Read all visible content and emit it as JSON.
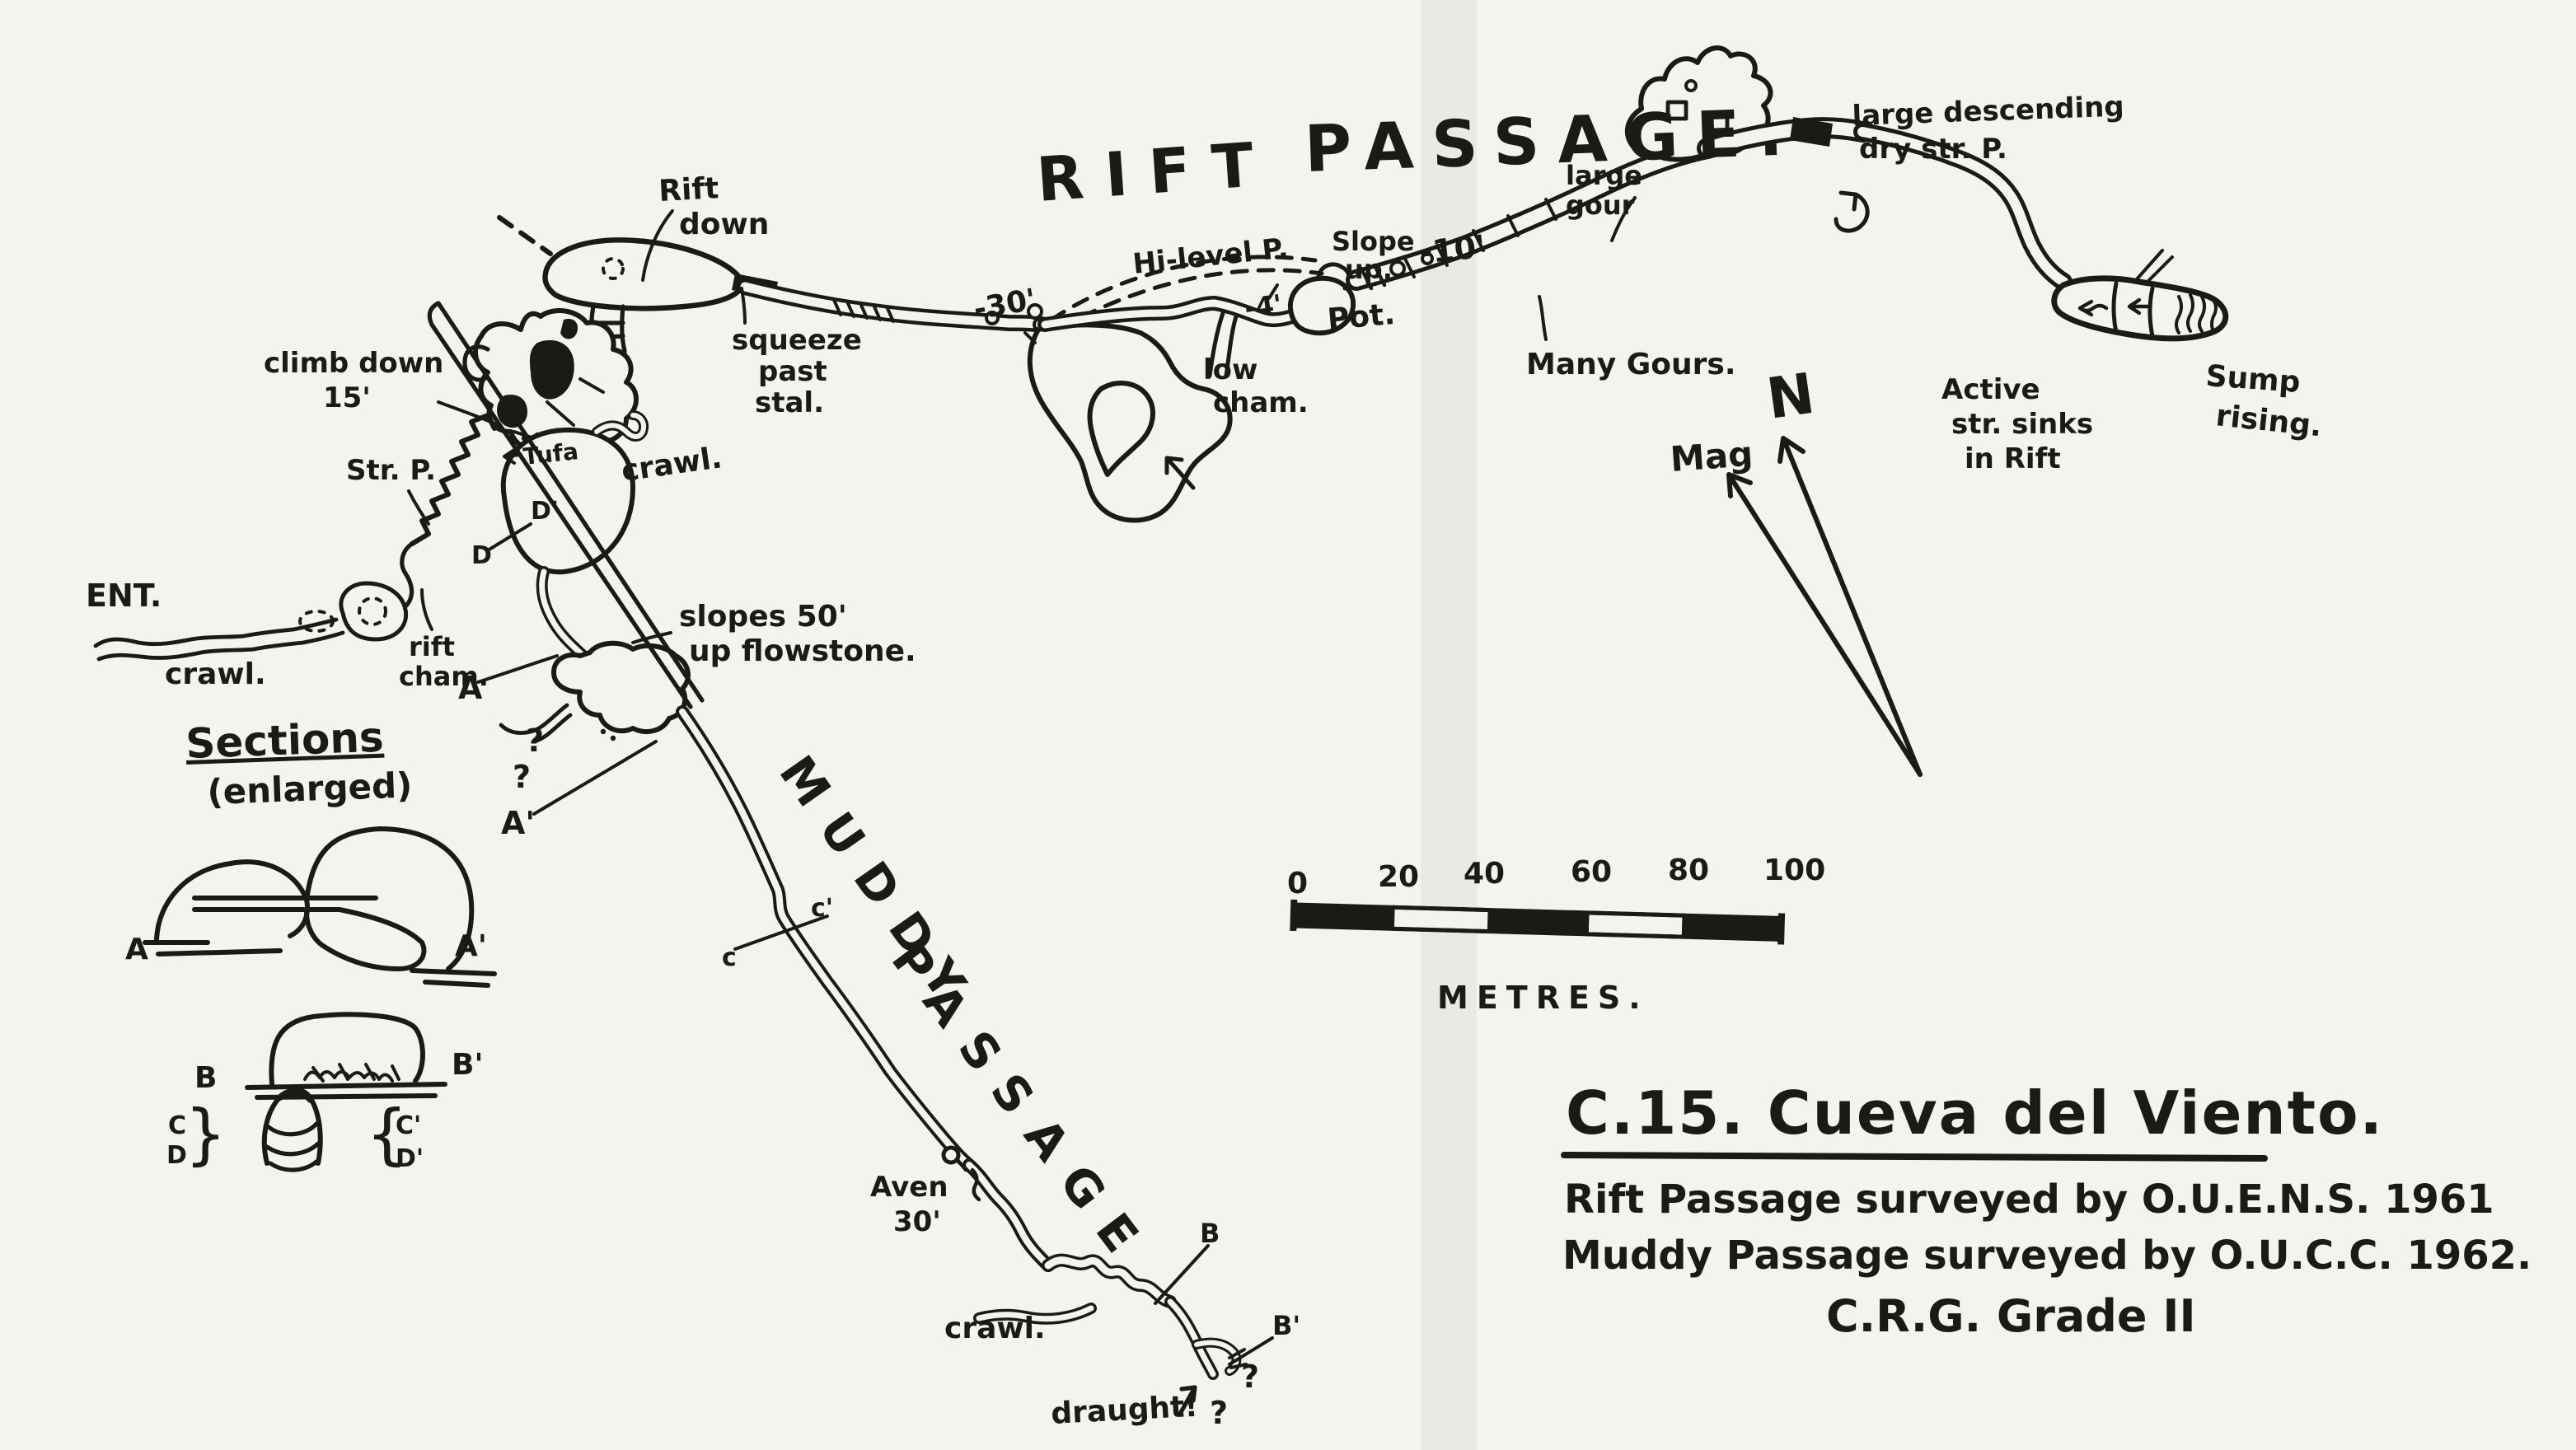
{
  "colors": {
    "ink": "#1c1a17",
    "paper": "#f5f3ee"
  },
  "header": {
    "rift": "RIFT",
    "passage": "PASSAGE."
  },
  "labels": {
    "rift_down_1": "Rift",
    "rift_down_2": "down",
    "squeeze_1": "squeeze",
    "squeeze_2": "past",
    "squeeze_3": "stal.",
    "depth30": "-30'",
    "hi_level": "Hi-level P.",
    "slope_up_1": "Slope",
    "slope_up_2": "up.",
    "depth10": "-10'",
    "depth4": "-4'",
    "pot": "Pot.",
    "low_cham_1": "low",
    "low_cham_2": "cham.",
    "large_gour_1": "large",
    "large_gour_2": "gour",
    "many_gours": "Many Gours.",
    "dry_1": "large descending",
    "dry_2": "dry str. P.",
    "active_1": "Active",
    "active_2": "str. sinks",
    "active_3": "in Rift",
    "sump_1": "Sump",
    "sump_2": "rising.",
    "climb_1": "climb down",
    "climb_2": "15'",
    "str_p": "Str. P.",
    "tufa": "Tufa",
    "ent": "ENT.",
    "ent_crawl": "crawl.",
    "rift_cham_1": "rift",
    "rift_cham_2": "cham.",
    "mid_crawl": "crawl.",
    "slopes_1": "slopes 50'",
    "slopes_2": "up flowstone.",
    "q_a1": "?",
    "q_a2": "?",
    "marker_a": "A",
    "marker_a2": "A'",
    "marker_d": "D",
    "marker_d2": "D'"
  },
  "muddy": {
    "word1": "MUDDY",
    "word2": "PASSAGE",
    "marker_c": "c",
    "marker_c2": "c'",
    "aven_1": "Aven",
    "aven_2": "30'",
    "crawl": "crawl.",
    "draught": "draught!",
    "q1": "?",
    "q2": "?",
    "marker_b": "B",
    "marker_b2": "B'"
  },
  "sections": {
    "title": "Sections",
    "subtitle": "(enlarged)",
    "a": "A",
    "a2": "A'",
    "b": "B",
    "b2": "B'",
    "c": "C",
    "d": "D",
    "brace_left": "}",
    "brace_right": "{",
    "c2": "C'",
    "d2": "D'"
  },
  "scale": {
    "ticks": [
      "0",
      "20",
      "40",
      "60",
      "80",
      "100"
    ],
    "unit": "METRES."
  },
  "north": {
    "n": "N",
    "mag": "Mag"
  },
  "title_block": {
    "title": "C.15. Cueva del Viento.",
    "line1": "Rift Passage surveyed by O.U.E.N.S. 1961",
    "line2": "Muddy Passage surveyed by O.U.C.C. 1962.",
    "line3": "C.R.G.  Grade II"
  }
}
